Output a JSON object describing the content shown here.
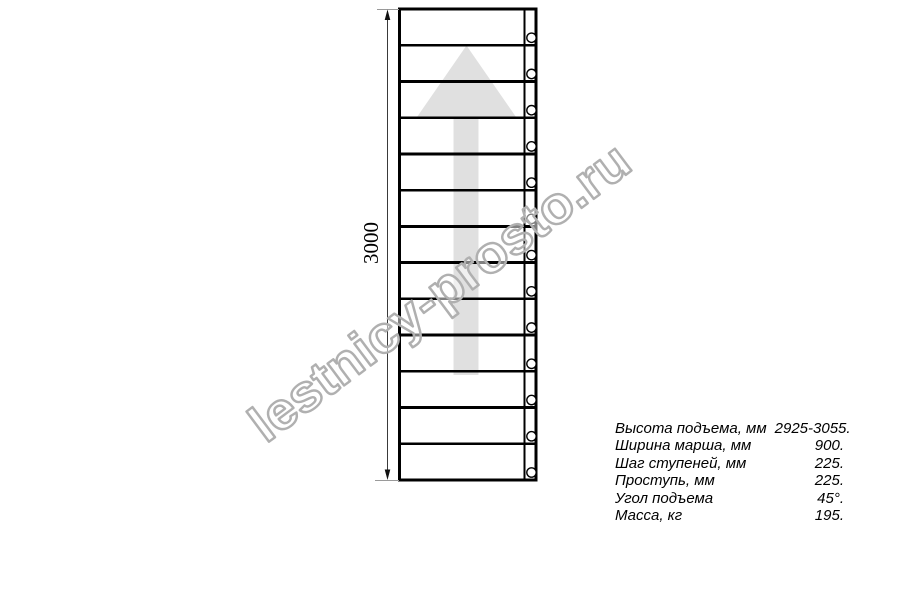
{
  "drawing": {
    "dimension": {
      "label": "3000"
    },
    "treads_count": 13,
    "arrow_icon": "up-arrow",
    "colors": {
      "line": "#000000",
      "arrow_fill": "#e0e0e0",
      "dimension_line": "#3a3a3a",
      "extension_line": "#9a9a9a",
      "watermark": "#b0b0b0"
    }
  },
  "watermark": {
    "text": "lestnicy-prosto.ru"
  },
  "specs": {
    "rows": [
      {
        "label": "Высота подъема, мм",
        "value": "2925-3055."
      },
      {
        "label": "Ширина марша, мм",
        "value": "900."
      },
      {
        "label": "Шаг ступеней, мм",
        "value": "225."
      },
      {
        "label": "Проступь, мм",
        "value": "225."
      },
      {
        "label": "Угол подъема",
        "value": "45°."
      },
      {
        "label": "Масса, кг",
        "value": "195."
      }
    ]
  }
}
